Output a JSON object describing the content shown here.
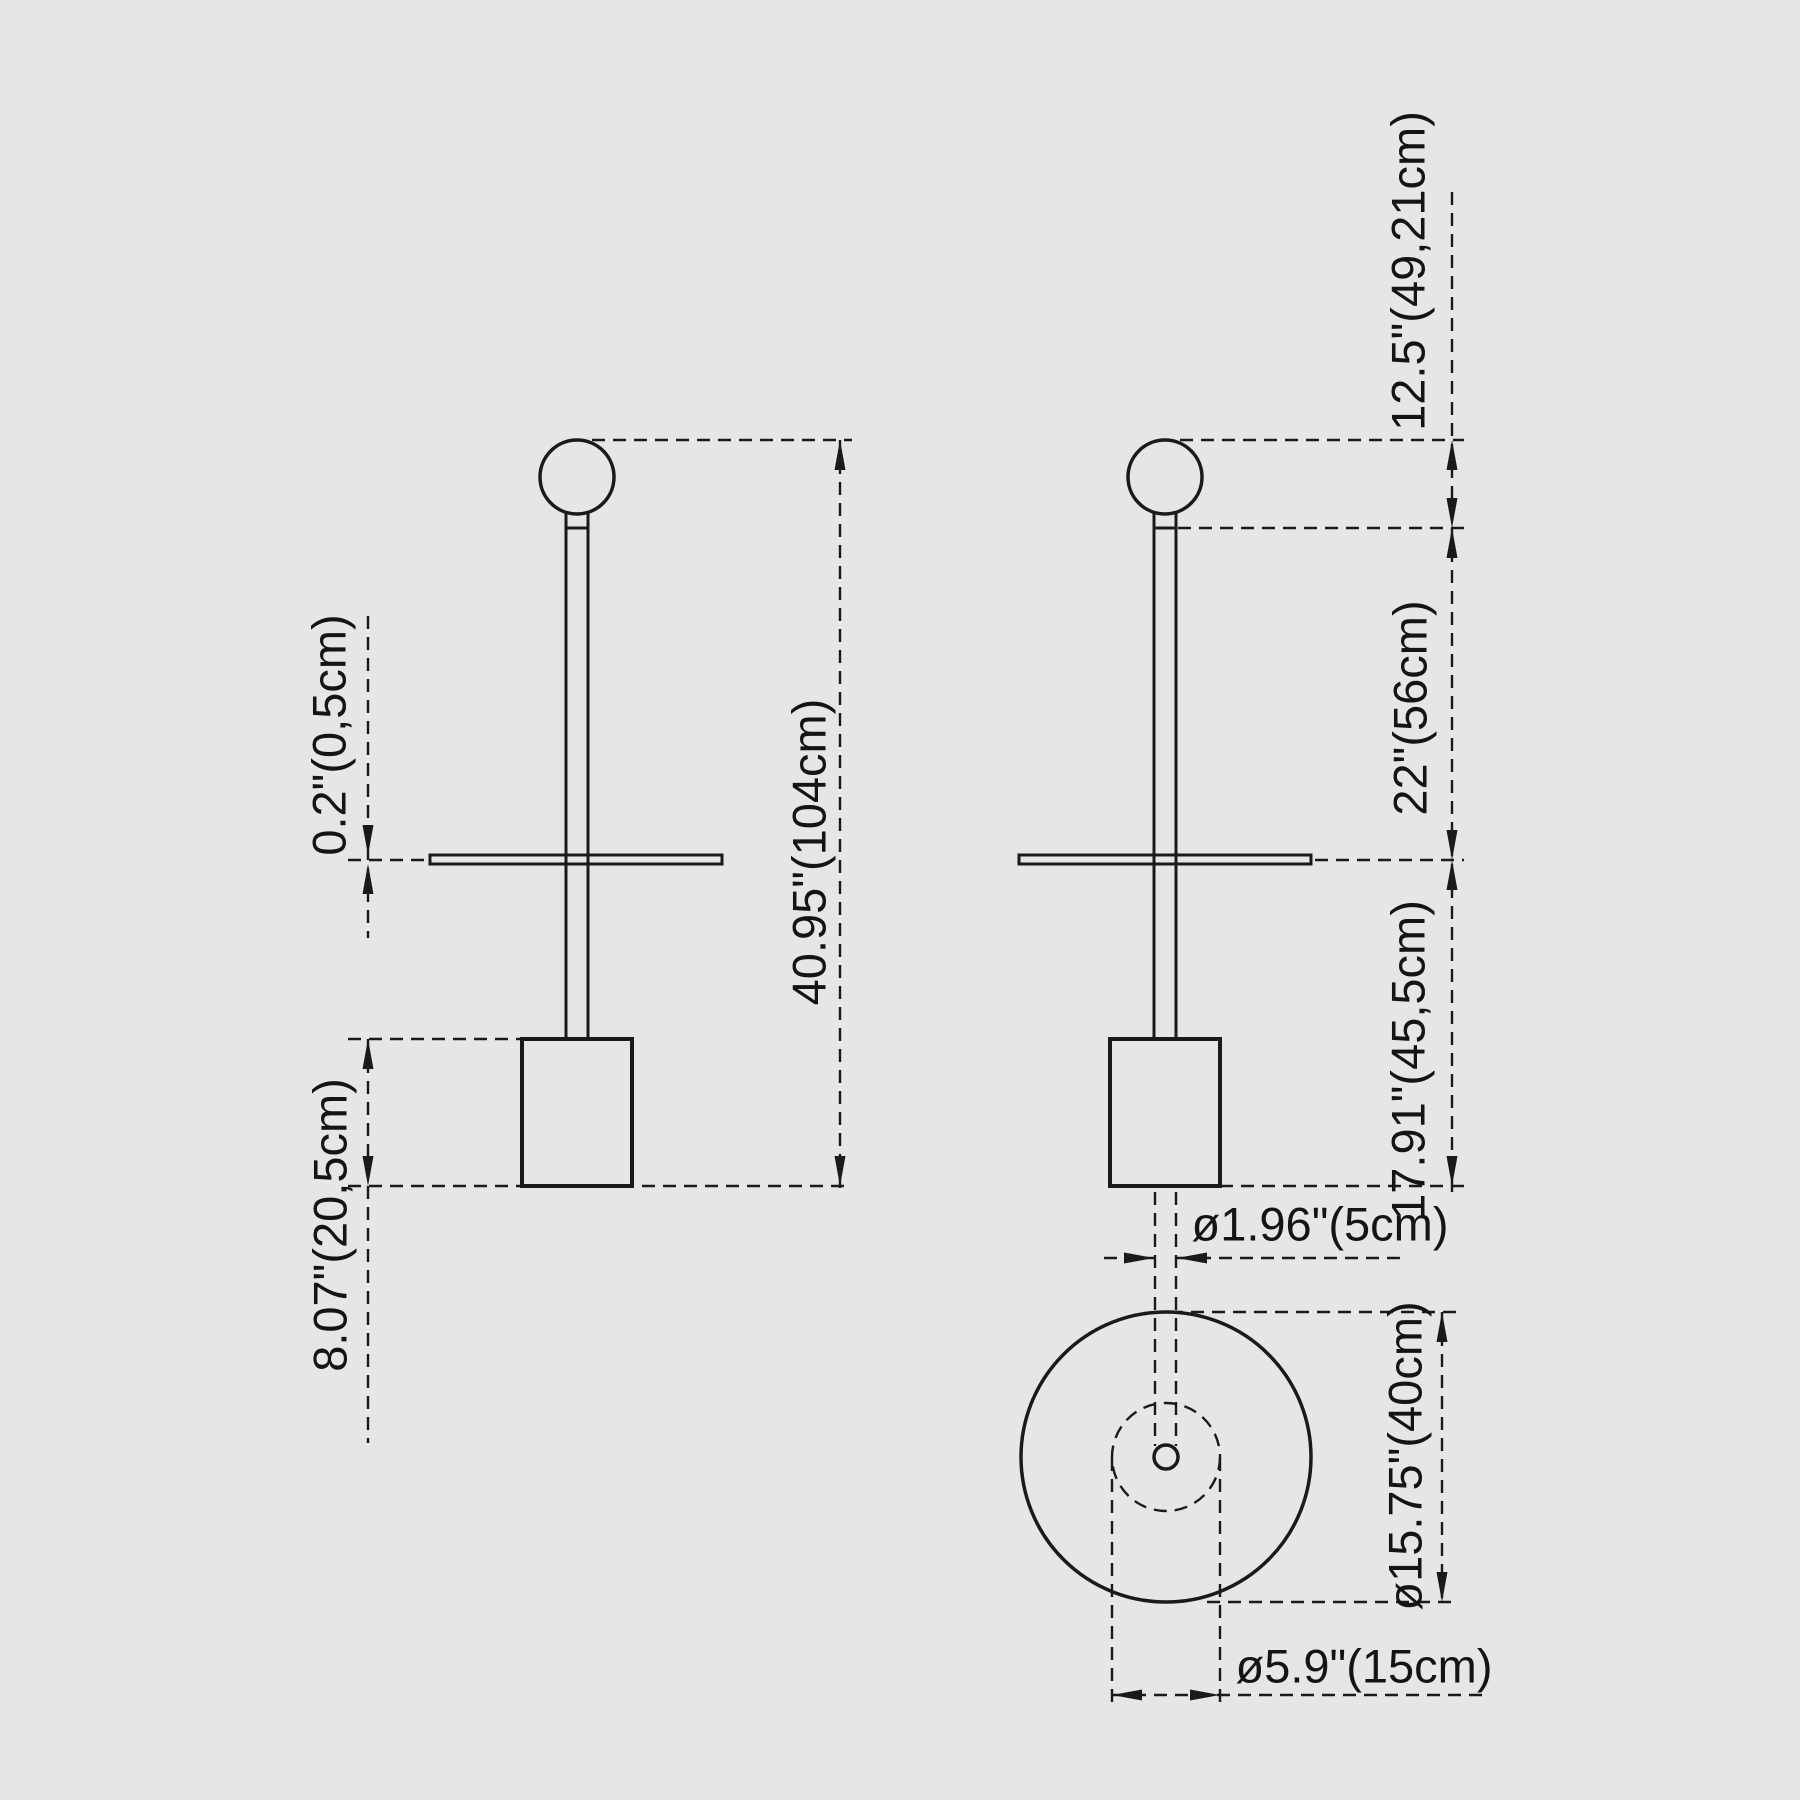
{
  "colors": {
    "background": "#e6e6e6",
    "line": "#1a1a1a",
    "text": "#141414"
  },
  "views": {
    "front": {
      "labels": {
        "disc_thickness": "0.2\"(0,5cm)",
        "base_height": "8.07\"(20,5cm)",
        "total_height": "40.95\"(104cm)"
      }
    },
    "side": {
      "labels": {
        "head_height": "12.5\"(49,21cm)",
        "upper_section": "22\"(56cm)",
        "lower_section": "17.91\"(45,5cm)"
      }
    },
    "top": {
      "labels": {
        "pole_diameter": "ø1.96\"(5cm)",
        "table_diameter": "ø15.75\"(40cm)",
        "base_diameter": "ø5.9\"(15cm)"
      }
    }
  }
}
